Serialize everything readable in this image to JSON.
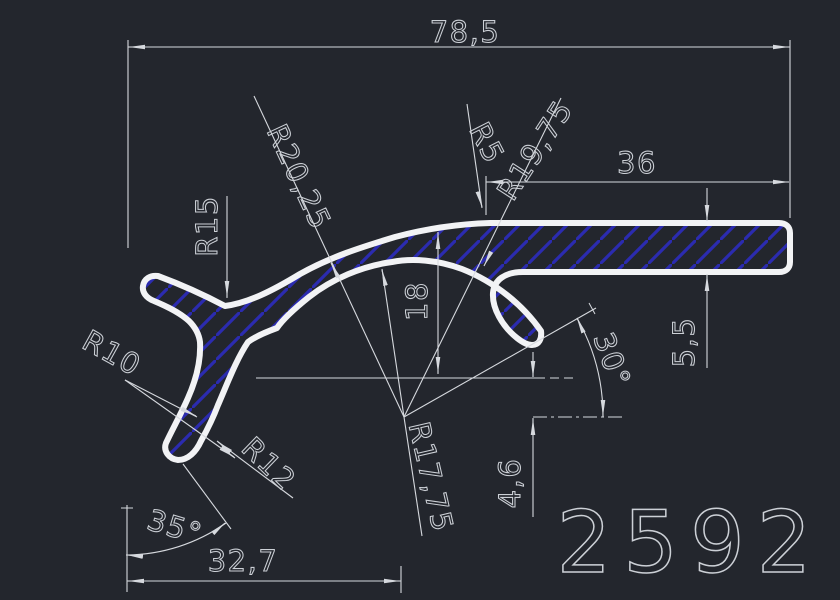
{
  "drawing": {
    "part_number": "2592",
    "dimensions": {
      "total_width": "78,5",
      "bar_width": "36",
      "bar_thickness": "5,5",
      "hump_height": "18",
      "vertical_offset": "4,6",
      "base_width": "32,7",
      "angle_right": "30°",
      "angle_left": "35°",
      "radius_r15": "R15",
      "radius_r20": "R20,25",
      "radius_r5": "R5",
      "radius_r19": "R19,75",
      "radius_r17": "R17,75",
      "radius_r10": "R10",
      "radius_r12": "R12"
    },
    "colors": {
      "background": "#23262d",
      "profile_stroke": "#f2f3f5",
      "hatch": "#2b2bb0",
      "dimension": "#d6d9de",
      "text": "#ccd0d6"
    }
  }
}
